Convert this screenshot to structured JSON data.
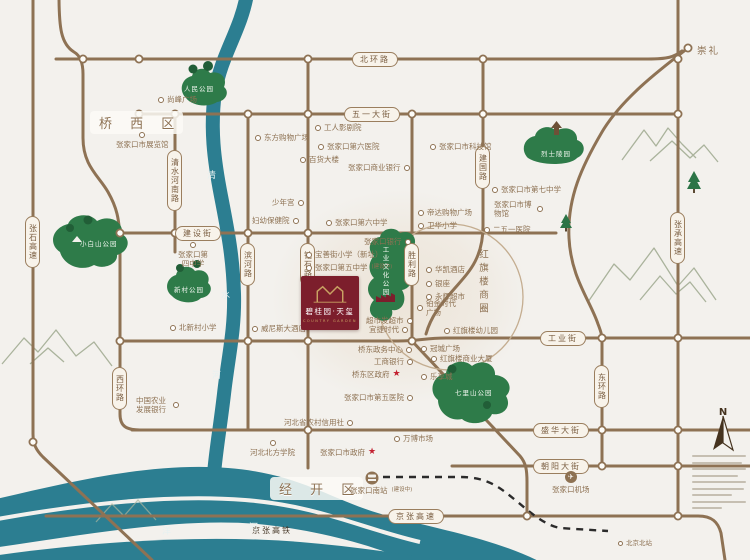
{
  "districts": [
    {
      "name": "qiaoxi",
      "label": "桥 西 区",
      "x": 90,
      "y": 111
    },
    {
      "name": "jingkai",
      "label": "经 开 区",
      "x": 270,
      "y": 477
    }
  ],
  "business_circle": {
    "label": "红旗楼商圈"
  },
  "project": {
    "name_cn": "碧桂园·天玺",
    "name_en": "COUNTRY GARDEN"
  },
  "compass": {
    "label": "N"
  },
  "icons": {
    "star": "★",
    "plane": "✈"
  },
  "road_labels": [
    {
      "name": "beihuanlu",
      "label": "北环路",
      "x": 352,
      "y": 52
    },
    {
      "name": "wuyidajie",
      "label": "五一大街",
      "x": 344,
      "y": 107
    },
    {
      "name": "jianshejie",
      "label": "建设街",
      "x": 175,
      "y": 226
    },
    {
      "name": "gongyejie",
      "label": "工业街",
      "x": 540,
      "y": 331
    },
    {
      "name": "shenghuadajie",
      "label": "盛华大街",
      "x": 533,
      "y": 423
    },
    {
      "name": "chaoyangdajie",
      "label": "朝阳大街",
      "x": 533,
      "y": 459
    },
    {
      "name": "jingzhanggaosu",
      "label": "京张高速",
      "x": 388,
      "y": 509
    },
    {
      "name": "qingshuihenanlu",
      "label": "清水河南路",
      "x": 167,
      "y": 150,
      "v": true
    },
    {
      "name": "binhelu",
      "label": "滨河路",
      "x": 240,
      "y": 243,
      "v": true
    },
    {
      "name": "zuanshilu",
      "label": "钻石路",
      "x": 300,
      "y": 243,
      "v": true
    },
    {
      "name": "shenglilu",
      "label": "胜利路",
      "x": 404,
      "y": 243,
      "v": true
    },
    {
      "name": "jianguolu",
      "label": "建国路",
      "x": 475,
      "y": 146,
      "v": true
    },
    {
      "name": "donghuanlu",
      "label": "东环路",
      "x": 594,
      "y": 365,
      "v": true
    },
    {
      "name": "xihuanlu",
      "label": "西环路",
      "x": 112,
      "y": 367,
      "v": true
    },
    {
      "name": "zhangshigaosu",
      "label": "张石高速",
      "x": 25,
      "y": 216,
      "v": true
    },
    {
      "name": "zhangchenggaosu",
      "label": "张承高速",
      "x": 670,
      "y": 212,
      "v": true
    }
  ],
  "pois": [
    {
      "name": "shangfeng-plaza",
      "label": "尚峰广场",
      "x": 158,
      "y": 95
    },
    {
      "name": "exhibition-hall",
      "label": "张家口市展览馆",
      "x": 116,
      "y": 132,
      "side": "top"
    },
    {
      "name": "dongfang-mall",
      "label": "东方购物广场",
      "x": 255,
      "y": 133
    },
    {
      "name": "department-store",
      "label": "百货大楼",
      "x": 300,
      "y": 155
    },
    {
      "name": "workers-theater",
      "label": "工人影剧院",
      "x": 315,
      "y": 123
    },
    {
      "name": "no6-hospital",
      "label": "张家口第六医院",
      "x": 318,
      "y": 142
    },
    {
      "name": "commercial-bank",
      "label": "张家口商业银行",
      "x": 348,
      "y": 163,
      "side": "right"
    },
    {
      "name": "youth-palace",
      "label": "少年宫",
      "x": 272,
      "y": 198,
      "side": "right"
    },
    {
      "name": "maternity-hospital",
      "label": "妇幼保健院",
      "x": 252,
      "y": 216,
      "side": "right"
    },
    {
      "name": "no6-middle-school",
      "label": "张家口第六中学",
      "x": 326,
      "y": 218
    },
    {
      "name": "science-museum",
      "label": "张家口市科技馆",
      "x": 430,
      "y": 142
    },
    {
      "name": "dida-mall",
      "label": "帝达购物广场",
      "x": 418,
      "y": 208
    },
    {
      "name": "weihua-primary",
      "label": "卫华小学",
      "x": 418,
      "y": 221
    },
    {
      "name": "no7-middle-school",
      "label": "张家口市第七中学",
      "x": 492,
      "y": 185
    },
    {
      "name": "city-museum",
      "label": "张家口市博物馆",
      "x": 494,
      "y": 200,
      "side": "right",
      "maxw": 40
    },
    {
      "name": "hospital-251",
      "label": "二五一医院",
      "x": 484,
      "y": 225
    },
    {
      "name": "chongli",
      "label": "崇礼",
      "x": 697,
      "y": 46,
      "icon": "none",
      "cls": "lg"
    },
    {
      "name": "zjk-bank",
      "label": "张家口银行",
      "x": 364,
      "y": 237,
      "side": "right"
    },
    {
      "name": "baoshanjie-primary",
      "label": "宝善街小学（新址）",
      "x": 306,
      "y": 250
    },
    {
      "name": "no5-middle-school",
      "label": "张家口第五中学",
      "sub": "(建设中)",
      "x": 306,
      "y": 263
    },
    {
      "name": "qiaodong-kindergarten",
      "label": "桥东一幼",
      "x": 306,
      "y": 277
    },
    {
      "name": "venice-hotel",
      "label": "威尼斯大酒店",
      "x": 252,
      "y": 324
    },
    {
      "name": "huakai-hotel",
      "label": "华凯酒店",
      "x": 426,
      "y": 265
    },
    {
      "name": "yinzuo",
      "label": "银座",
      "x": 426,
      "y": 279
    },
    {
      "name": "yonghui-supermarket",
      "label": "永辉超市",
      "x": 426,
      "y": 292
    },
    {
      "name": "platinum-times-plaza",
      "label": "铂金时代广场",
      "x": 417,
      "y": 299,
      "maxw": 36
    },
    {
      "name": "hongqilou-kindergarten",
      "label": "红旗楼幼儿园",
      "x": 444,
      "y": 326
    },
    {
      "name": "guancheng-plaza",
      "label": "冠城广场",
      "x": 421,
      "y": 344
    },
    {
      "name": "hongqilou-tower",
      "label": "红旗楼商业大厦",
      "x": 431,
      "y": 354
    },
    {
      "name": "lexiangcheng",
      "label": "乐享城",
      "x": 421,
      "y": 372
    },
    {
      "name": "chaoshifa-supermarket",
      "label": "超市发超市",
      "x": 366,
      "y": 316,
      "side": "right"
    },
    {
      "name": "yijie-times",
      "label": "宜捷时代",
      "x": 369,
      "y": 325,
      "side": "right"
    },
    {
      "name": "qiaodong-admin-center",
      "label": "桥东政务中心",
      "x": 358,
      "y": 345,
      "side": "right"
    },
    {
      "name": "icbc-bank",
      "label": "工商银行",
      "x": 374,
      "y": 357,
      "side": "right"
    },
    {
      "name": "qiaodong-government",
      "label": "桥东区政府",
      "x": 352,
      "y": 370,
      "side": "right",
      "icon": "star"
    },
    {
      "name": "no5-hospital",
      "label": "张家口市第五医院",
      "x": 344,
      "y": 393,
      "side": "right"
    },
    {
      "name": "rural-credit-union",
      "label": "河北省农村信用社",
      "x": 284,
      "y": 418,
      "side": "right"
    },
    {
      "name": "wanbo-market",
      "label": "万博市场",
      "x": 394,
      "y": 434
    },
    {
      "name": "hebei-north-university",
      "label": "河北北方学院",
      "x": 250,
      "y": 440,
      "side": "top"
    },
    {
      "name": "city-government",
      "label": "张家口市政府",
      "x": 320,
      "y": 448,
      "side": "right",
      "icon": "star"
    },
    {
      "name": "no4-middle-school",
      "label": "张家口第四中学",
      "x": 176,
      "y": 242,
      "side": "top",
      "maxw": 34
    },
    {
      "name": "beixincun-primary",
      "label": "北新村小学",
      "x": 170,
      "y": 323
    },
    {
      "name": "agri-development-bank",
      "label": "中国农业发展银行",
      "x": 136,
      "y": 396,
      "side": "right",
      "maxw": 34
    },
    {
      "name": "zjk-airport",
      "label": "张家口机场",
      "x": 552,
      "y": 471,
      "side": "top",
      "icon": "plane"
    },
    {
      "name": "zjk-south-station",
      "label": "张家口南站",
      "sub": "(建设中)",
      "x": 350,
      "y": 486,
      "icon": "none"
    },
    {
      "name": "beijing-north-station",
      "label": "北京北站",
      "x": 618,
      "y": 539,
      "icon": "donut-sm",
      "cls": "sm"
    },
    {
      "name": "jingzhang-hsr",
      "label": "京张高铁",
      "x": 252,
      "y": 526,
      "icon": "none",
      "cls": "rail"
    }
  ],
  "park_labels": [
    {
      "name": "renmin-park",
      "label": "人民公园",
      "x": 184,
      "y": 83
    },
    {
      "name": "martyrs-cemetery",
      "label": "烈士陵园",
      "x": 541,
      "y": 148
    },
    {
      "name": "xiaobaishan-park",
      "label": "小白山公园",
      "x": 80,
      "y": 238
    },
    {
      "name": "xincun-park",
      "label": "新村公园",
      "x": 174,
      "y": 284
    },
    {
      "name": "qilishan-park",
      "label": "七里山公园",
      "x": 455,
      "y": 387
    },
    {
      "name": "industrial-culture-park",
      "label": "工业文化公园",
      "x": 380,
      "y": 246,
      "v": true
    }
  ],
  "river_labels": [
    {
      "name": "qingshui-river-1",
      "label": "清",
      "x": 207,
      "y": 168
    },
    {
      "name": "qingshui-river-2",
      "label": "水",
      "x": 221,
      "y": 288
    },
    {
      "name": "qingshui-river-3",
      "label": "河",
      "x": 212,
      "y": 368
    },
    {
      "name": "yang-river-1",
      "label": "洋",
      "x": 162,
      "y": 524
    },
    {
      "name": "yang-river-2",
      "label": "河",
      "x": 249,
      "y": 520
    }
  ]
}
